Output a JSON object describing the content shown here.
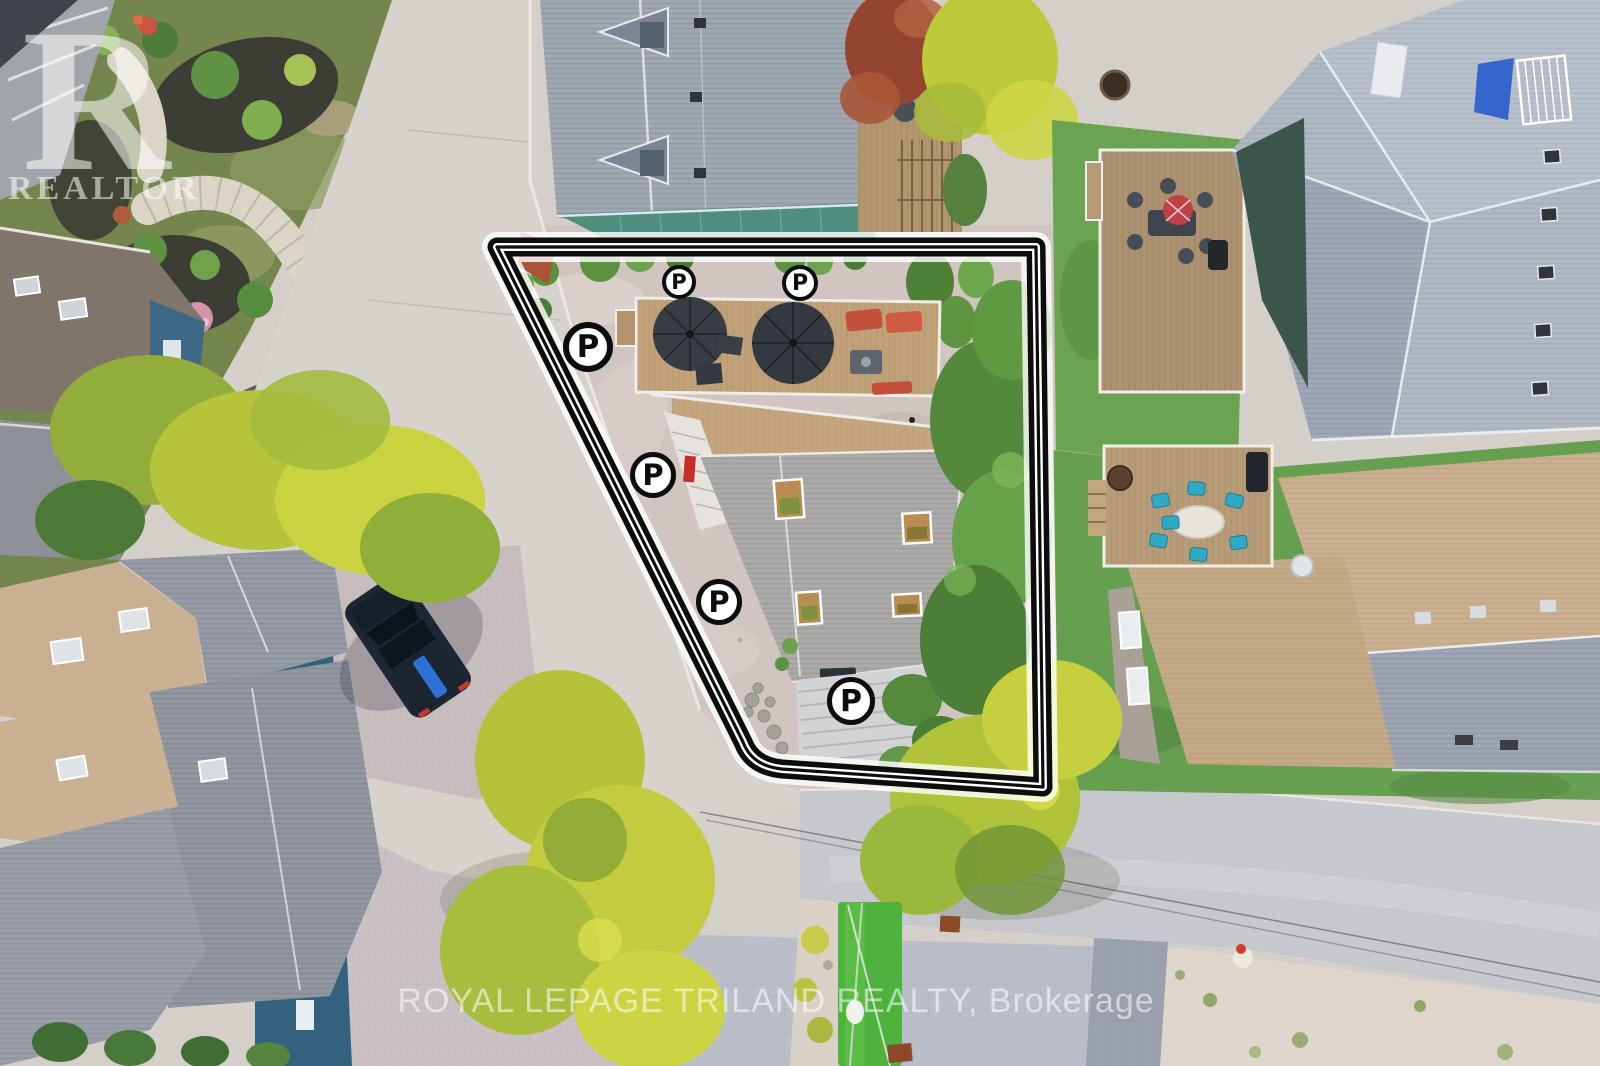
{
  "watermarks": {
    "realtor_logo_letter": "R",
    "realtor_logo_text": "REALTOR",
    "brokerage_text": "ROYAL LEPAGE TRILAND REALTY, Brokerage",
    "color": "rgba(255,255,255,0.55)"
  },
  "annotations": {
    "parking_markers": {
      "letter": "P",
      "fill": "#ffffff",
      "stroke": "#0d0d0d",
      "letter_color": "#0d0d0d",
      "positions": [
        {
          "x": 679,
          "y": 282,
          "d": 34
        },
        {
          "x": 800,
          "y": 283,
          "d": 36
        },
        {
          "x": 588,
          "y": 347,
          "d": 50
        },
        {
          "x": 653,
          "y": 475,
          "d": 46
        },
        {
          "x": 719,
          "y": 602,
          "d": 46
        },
        {
          "x": 851,
          "y": 701,
          "d": 48
        }
      ]
    },
    "property_outline": {
      "path": "M497,247 L1036,247 L1043,787 L782,769 Q752,766 743,742 Z",
      "line_color": "#0d0d0d",
      "gap_color": "#ffffff"
    }
  },
  "palette": {
    "street_concrete": "#d7d2cc",
    "road_asphalt": "#c6c8ce",
    "paver_pink": "#c9c1c3",
    "paver_blue": "#babec9",
    "lot_gravel": "#d0c5c1",
    "roof_gray": "#a9a7a6",
    "roof_blue_gray": "#9ca4ae",
    "roof_tan": "#c9ae8d",
    "teal_metal_roof": "#4f8d7e",
    "lawn_green": "#679f50",
    "turf_green": "#4fb23c",
    "tree_yellow_green": "#b9c63a",
    "tree_green": "#55883c",
    "deck_wood": "#bf9f78",
    "blue_siding": "#33627f",
    "suv_navy": "#1d2734",
    "umbrella_charcoal": "#383d44",
    "lounger_red": "#c2503a",
    "chair_teal": "#2fa9c4"
  }
}
